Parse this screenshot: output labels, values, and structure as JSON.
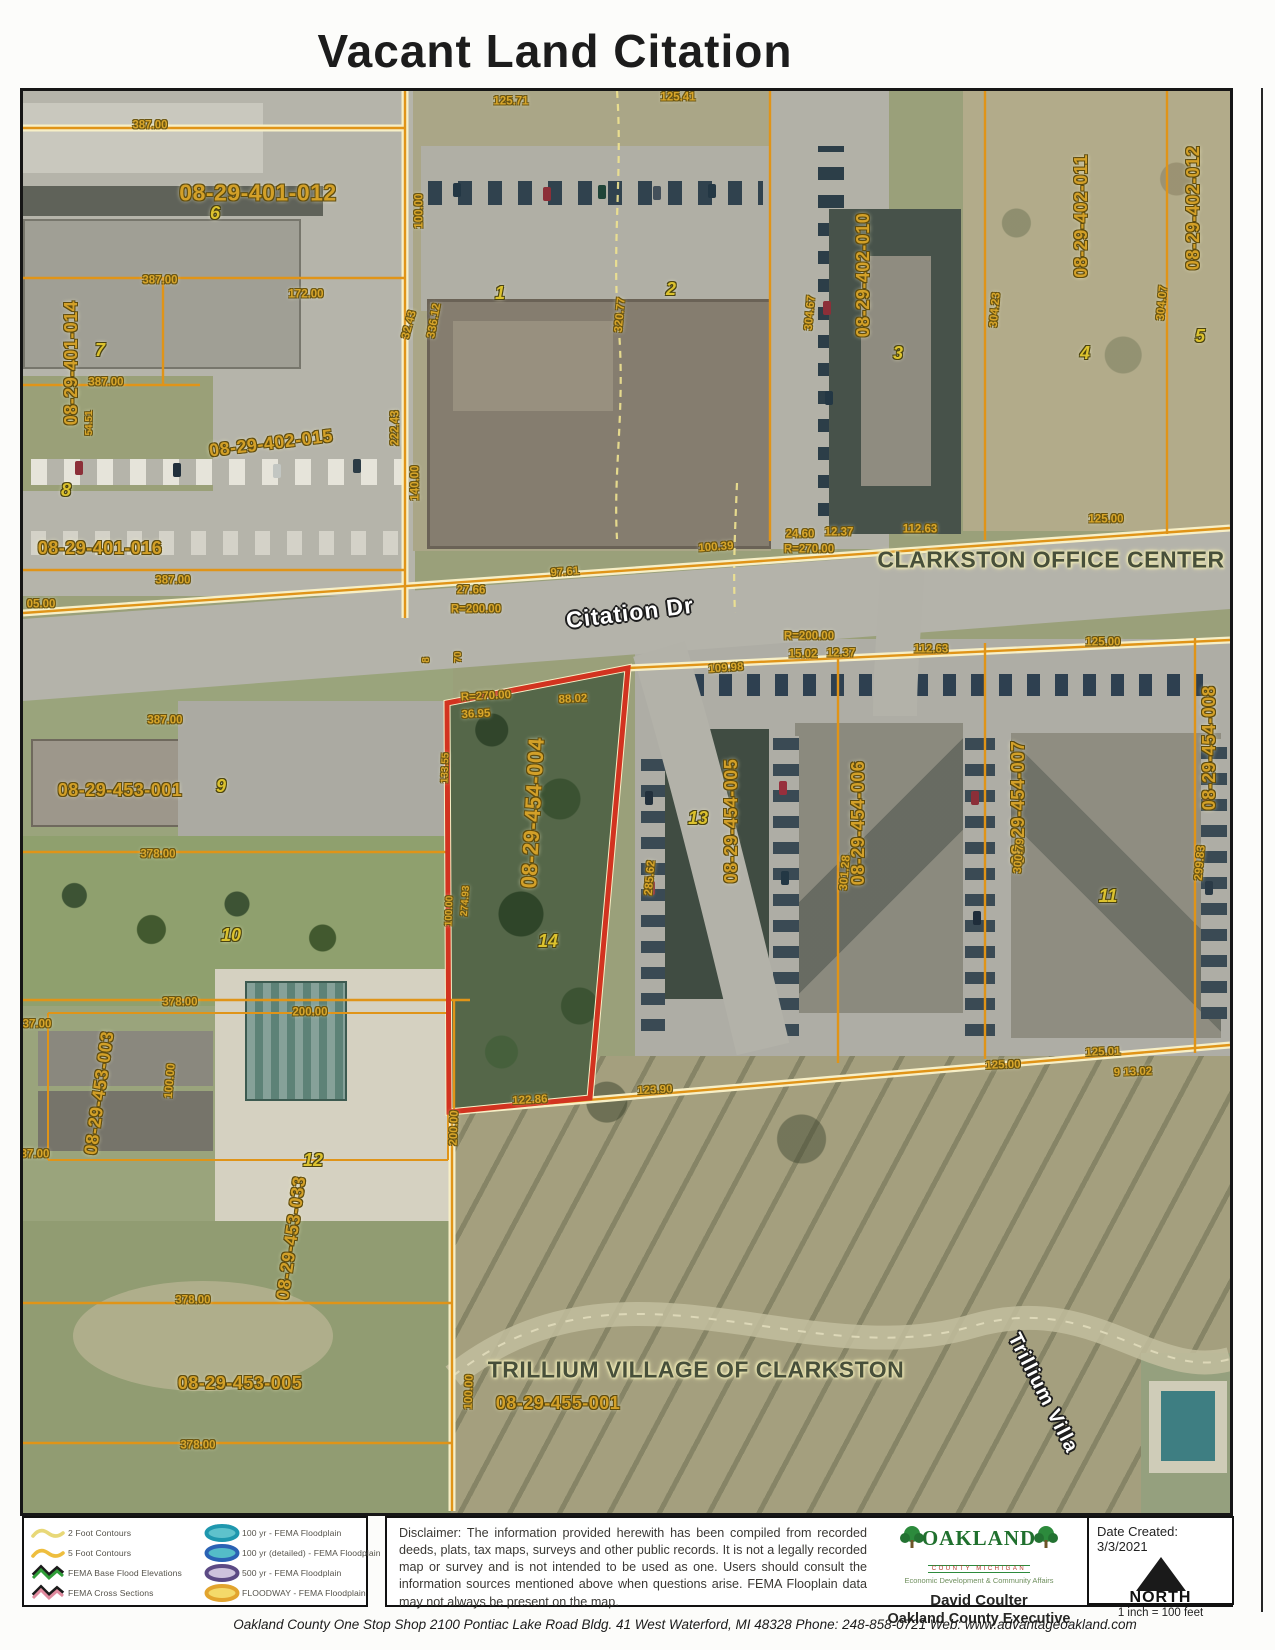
{
  "title": "Vacant Land Citation",
  "map": {
    "labels": [
      {
        "t": "387.00",
        "x": 127,
        "y": 35,
        "c": "dim"
      },
      {
        "t": "08-29-401-012",
        "x": 235,
        "y": 102,
        "c": "pid",
        "fs": 23
      },
      {
        "t": "6",
        "x": 192,
        "y": 122,
        "c": "lot"
      },
      {
        "t": "387.00",
        "x": 137,
        "y": 190,
        "c": "dim"
      },
      {
        "t": "172.00",
        "x": 283,
        "y": 204,
        "c": "dim"
      },
      {
        "t": "08-29-401-014",
        "x": 48,
        "y": 272,
        "r": -90,
        "c": "pid"
      },
      {
        "t": "7",
        "x": 77,
        "y": 259,
        "c": "lot"
      },
      {
        "t": "387.00",
        "x": 83,
        "y": 292,
        "c": "dim"
      },
      {
        "t": "54.51",
        "x": 67,
        "y": 332,
        "r": -90,
        "c": "dim",
        "fs": 10
      },
      {
        "t": "08-29-402-015",
        "x": 248,
        "y": 352,
        "r": -7,
        "c": "pid"
      },
      {
        "t": "8",
        "x": 43,
        "y": 399,
        "c": "lot"
      },
      {
        "t": "08-29-401-016",
        "x": 77,
        "y": 457,
        "c": "pid"
      },
      {
        "t": "387.00",
        "x": 150,
        "y": 490,
        "c": "dim"
      },
      {
        "t": "05.00",
        "x": 18,
        "y": 514,
        "c": "dim"
      },
      {
        "t": "100.00",
        "x": 397,
        "y": 120,
        "r": -90,
        "c": "dim"
      },
      {
        "t": "32.43",
        "x": 387,
        "y": 234,
        "r": -75,
        "c": "dim"
      },
      {
        "t": "336.12",
        "x": 412,
        "y": 230,
        "r": -80,
        "c": "dim"
      },
      {
        "t": "222.43",
        "x": 373,
        "y": 337,
        "r": -90,
        "c": "dim"
      },
      {
        "t": "140.00",
        "x": 393,
        "y": 392,
        "r": -90,
        "c": "dim"
      },
      {
        "t": "125.71",
        "x": 488,
        "y": 11,
        "c": "dim"
      },
      {
        "t": "125.41",
        "x": 655,
        "y": 7,
        "c": "dim"
      },
      {
        "t": "1",
        "x": 477,
        "y": 202,
        "c": "lot"
      },
      {
        "t": "2",
        "x": 648,
        "y": 198,
        "c": "lot"
      },
      {
        "t": "320.77",
        "x": 598,
        "y": 224,
        "r": -85,
        "c": "dim"
      },
      {
        "t": "08-29-402-010",
        "x": 840,
        "y": 184,
        "r": -90,
        "c": "pid"
      },
      {
        "t": "3",
        "x": 875,
        "y": 262,
        "c": "lot"
      },
      {
        "t": "304.67",
        "x": 788,
        "y": 222,
        "r": -85,
        "c": "dim"
      },
      {
        "t": "304.23",
        "x": 973,
        "y": 219,
        "r": -85,
        "c": "dim"
      },
      {
        "t": "08-29-402-011",
        "x": 1058,
        "y": 125,
        "r": -90,
        "c": "pid"
      },
      {
        "t": "4",
        "x": 1062,
        "y": 262,
        "c": "lot"
      },
      {
        "t": "304.07",
        "x": 1140,
        "y": 212,
        "r": -85,
        "c": "dim"
      },
      {
        "t": "08-29-402-012",
        "x": 1170,
        "y": 117,
        "r": -90,
        "c": "pid"
      },
      {
        "t": "5",
        "x": 1177,
        "y": 245,
        "c": "lot"
      },
      {
        "t": "24.60",
        "x": 777,
        "y": 444,
        "c": "dim"
      },
      {
        "t": "12.37",
        "x": 816,
        "y": 442,
        "c": "dim"
      },
      {
        "t": "R=270.00",
        "x": 786,
        "y": 459,
        "c": "dim"
      },
      {
        "t": "112.63",
        "x": 897,
        "y": 439,
        "c": "dim"
      },
      {
        "t": "125.00",
        "x": 1083,
        "y": 429,
        "c": "dim"
      },
      {
        "t": "CLARKSTON OFFICE CENTER",
        "x": 1028,
        "y": 469,
        "c": "area"
      },
      {
        "t": "100.39",
        "x": 693,
        "y": 457,
        "r": -4,
        "c": "dim"
      },
      {
        "t": "97.61",
        "x": 542,
        "y": 482,
        "r": -4,
        "c": "dim"
      },
      {
        "t": "27.66",
        "x": 448,
        "y": 500,
        "c": "dim"
      },
      {
        "t": "R=200.00",
        "x": 453,
        "y": 519,
        "c": "dim"
      },
      {
        "t": "Citation Dr",
        "x": 607,
        "y": 522,
        "r": -7,
        "c": "street"
      },
      {
        "t": "387.00",
        "x": 142,
        "y": 630,
        "c": "dim"
      },
      {
        "t": "R=200.00",
        "x": 786,
        "y": 546,
        "c": "dim"
      },
      {
        "t": "15.02",
        "x": 780,
        "y": 564,
        "c": "dim"
      },
      {
        "t": "12.37",
        "x": 818,
        "y": 563,
        "c": "dim"
      },
      {
        "t": "112.63",
        "x": 908,
        "y": 559,
        "c": "dim"
      },
      {
        "t": "125.00",
        "x": 1080,
        "y": 552,
        "c": "dim"
      },
      {
        "t": "109.98",
        "x": 703,
        "y": 578,
        "r": -4,
        "c": "dim"
      },
      {
        "t": "R=270.00",
        "x": 463,
        "y": 606,
        "r": -3,
        "c": "dim"
      },
      {
        "t": "88.02",
        "x": 550,
        "y": 609,
        "r": -3,
        "c": "dim"
      },
      {
        "t": "36.95",
        "x": 453,
        "y": 624,
        "r": -3,
        "c": "dim"
      },
      {
        "t": "8",
        "x": 404,
        "y": 569,
        "r": -90,
        "c": "dim",
        "fs": 10
      },
      {
        "t": "70",
        "x": 436,
        "y": 566,
        "r": -90,
        "c": "dim",
        "fs": 10
      },
      {
        "t": "08-29-453-001",
        "x": 97,
        "y": 699,
        "c": "pid"
      },
      {
        "t": "9",
        "x": 198,
        "y": 695,
        "c": "lot"
      },
      {
        "t": "378.00",
        "x": 135,
        "y": 764,
        "c": "dim"
      },
      {
        "t": "10",
        "x": 208,
        "y": 844,
        "c": "lot"
      },
      {
        "t": "378.00",
        "x": 157,
        "y": 912,
        "c": "dim"
      },
      {
        "t": "200.00",
        "x": 287,
        "y": 922,
        "c": "dim"
      },
      {
        "t": "08-29-453-003",
        "x": 76,
        "y": 1002,
        "r": -82,
        "c": "pid"
      },
      {
        "t": "100.00",
        "x": 148,
        "y": 990,
        "r": -85,
        "c": "dim"
      },
      {
        "t": "37.00",
        "x": 14,
        "y": 934,
        "c": "dim"
      },
      {
        "t": "37.00",
        "x": 12,
        "y": 1064,
        "c": "dim"
      },
      {
        "t": "12",
        "x": 290,
        "y": 1069,
        "c": "lot"
      },
      {
        "t": "08-29-453-033",
        "x": 268,
        "y": 1147,
        "r": -82,
        "c": "pid"
      },
      {
        "t": "378.00",
        "x": 170,
        "y": 1210,
        "c": "dim"
      },
      {
        "t": "08-29-453-005",
        "x": 217,
        "y": 1292,
        "c": "pid"
      },
      {
        "t": "378.00",
        "x": 175,
        "y": 1355,
        "c": "dim"
      },
      {
        "t": "08-29-454-004",
        "x": 510,
        "y": 722,
        "r": -87,
        "c": "pid",
        "fs": 22
      },
      {
        "t": "14",
        "x": 525,
        "y": 850,
        "c": "lot"
      },
      {
        "t": "133.55",
        "x": 423,
        "y": 677,
        "r": -88,
        "c": "dim",
        "fs": 10
      },
      {
        "t": "274.93",
        "x": 443,
        "y": 810,
        "r": -86,
        "c": "dim",
        "fs": 10
      },
      {
        "t": "100.00",
        "x": 427,
        "y": 820,
        "r": -88,
        "c": "dim",
        "fs": 10
      },
      {
        "t": "285.62",
        "x": 628,
        "y": 787,
        "r": -85,
        "c": "dim"
      },
      {
        "t": "13",
        "x": 675,
        "y": 727,
        "c": "lot"
      },
      {
        "t": "08-29-454-005",
        "x": 708,
        "y": 730,
        "r": -90,
        "c": "pid"
      },
      {
        "t": "08-29-454-006",
        "x": 835,
        "y": 732,
        "r": -90,
        "c": "pid"
      },
      {
        "t": "301.28",
        "x": 823,
        "y": 782,
        "r": -85,
        "c": "dim"
      },
      {
        "t": "08-29-454-007",
        "x": 995,
        "y": 712,
        "r": -90,
        "c": "pid"
      },
      {
        "t": "300.79",
        "x": 997,
        "y": 765,
        "r": -85,
        "c": "dim"
      },
      {
        "t": "11",
        "x": 1085,
        "y": 805,
        "c": "lot"
      },
      {
        "t": "08-29-454-008",
        "x": 1186,
        "y": 657,
        "r": -90,
        "c": "pid"
      },
      {
        "t": "299.83",
        "x": 1178,
        "y": 772,
        "r": -85,
        "c": "dim"
      },
      {
        "t": "122.86",
        "x": 507,
        "y": 1010,
        "r": -3,
        "c": "dim"
      },
      {
        "t": "123.90",
        "x": 632,
        "y": 1000,
        "r": -3,
        "c": "dim"
      },
      {
        "t": "125.00",
        "x": 980,
        "y": 975,
        "r": -2,
        "c": "dim"
      },
      {
        "t": "125.01",
        "x": 1080,
        "y": 962,
        "r": -2,
        "c": "dim"
      },
      {
        "t": "9 13.02",
        "x": 1110,
        "y": 982,
        "r": -2,
        "c": "dim"
      },
      {
        "t": "200.00",
        "x": 432,
        "y": 1037,
        "r": -88,
        "c": "dim"
      },
      {
        "t": "TRILLIUM VILLAGE OF CLARKSTON",
        "x": 673,
        "y": 1279,
        "c": "area"
      },
      {
        "t": "08-29-455-001",
        "x": 535,
        "y": 1312,
        "c": "pid"
      },
      {
        "t": "100.00",
        "x": 447,
        "y": 1301,
        "r": -88,
        "c": "dim"
      },
      {
        "t": "Trillium  Villa",
        "x": 1020,
        "y": 1302,
        "r": 63,
        "c": "street",
        "fs": 20
      }
    ]
  },
  "legend": {
    "col1": [
      {
        "icon": "contour-2ft-icon",
        "label": "2 Foot Contours"
      },
      {
        "icon": "contour-5ft-icon",
        "label": "5 Foot Contours"
      },
      {
        "icon": "fema-base-flood-elevations-icon",
        "label": "FEMA Base Flood Elevations"
      },
      {
        "icon": "fema-cross-sections-icon",
        "label": "FEMA Cross Sections"
      }
    ],
    "col2": [
      {
        "icon": "floodplain-100yr-icon",
        "label": "100 yr - FEMA Floodplain"
      },
      {
        "icon": "floodplain-100yr-detailed-icon",
        "label": "100 yr (detailed) - FEMA Floodplain"
      },
      {
        "icon": "floodplain-500yr-icon",
        "label": "500 yr - FEMA Floodplain"
      },
      {
        "icon": "floodway-icon",
        "label": "FLOODWAY - FEMA Floodplain"
      }
    ]
  },
  "disclaimer": "Disclaimer:  The information provided herewith has been compiled from recorded deeds, plats, tax maps, surveys and other public records.  It is not a legally recorded map or survey and is not intended to be used as one.  Users should consult the information sources mentioned above when questions arise. FEMA Flooplain data may not always be present on the map.",
  "credits": {
    "org": "OAKLAND",
    "org_sub": "COUNTY MICHIGAN",
    "dept": "Economic Development & Community Affairs",
    "name": "David Coulter",
    "title": "Oakland County Executive"
  },
  "dateline": {
    "date": "Date Created: 3/3/2021",
    "north": "NORTH",
    "scale": "1 inch = 100 feet"
  },
  "footer": "Oakland County One Stop Shop   2100 Pontiac Lake Road  Bldg. 41 West   Waterford, MI 48328   Phone: 248-858-0721   Web: www.advantageoakland.com",
  "colors": {
    "parcel_line": "#e09418",
    "highlight_parcel": "#d23320",
    "dimension_text": "#d9a62a"
  }
}
